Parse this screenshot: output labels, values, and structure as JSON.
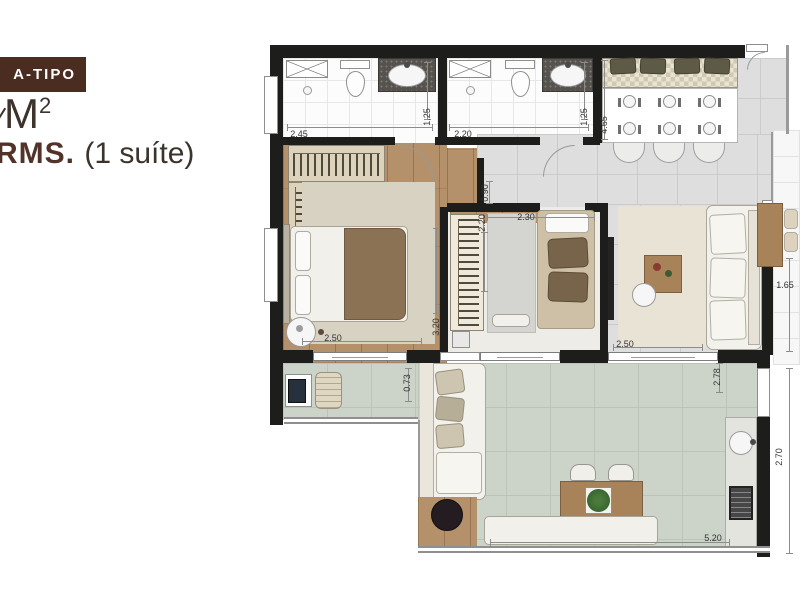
{
  "header": {
    "badge_label": "A-TIPO",
    "area_unit": "M",
    "area_sup": "2",
    "rooms_label": "RMS.",
    "suite_label": "(1 suíte)"
  },
  "colors": {
    "brand_brown": "#4a2c21",
    "wall_black": "#1d1d1b",
    "wood_floor": "#b4906b",
    "terrace_tile": "#ccd3c8",
    "gray_tile": "#dedede"
  },
  "floorplan": {
    "dimensions": [
      {
        "value": "2.45",
        "room": "suite-bathroom",
        "orientation": "horizontal"
      },
      {
        "value": "1.25",
        "room": "suite-bathroom",
        "orientation": "vertical"
      },
      {
        "value": "2.20",
        "room": "bathroom-2",
        "orientation": "horizontal"
      },
      {
        "value": "1.25",
        "room": "bathroom-2",
        "orientation": "vertical"
      },
      {
        "value": "4.65",
        "room": "kitchen-dining",
        "orientation": "vertical"
      },
      {
        "value": "0.90",
        "room": "hallway",
        "orientation": "vertical"
      },
      {
        "value": "2.20",
        "room": "bedroom-2",
        "orientation": "vertical"
      },
      {
        "value": "2.30",
        "room": "bedroom-2",
        "orientation": "horizontal"
      },
      {
        "value": "2.50",
        "room": "master-bedroom",
        "orientation": "horizontal"
      },
      {
        "value": "3.20",
        "room": "master-bedroom",
        "orientation": "vertical"
      },
      {
        "value": "2.50",
        "room": "living-room",
        "orientation": "horizontal"
      },
      {
        "value": "1.65",
        "room": "living-window",
        "orientation": "horizontal"
      },
      {
        "value": "0.73",
        "room": "balcony",
        "orientation": "vertical"
      },
      {
        "value": "2.78",
        "room": "terrace",
        "orientation": "vertical"
      },
      {
        "value": "2.70",
        "room": "terrace-right",
        "orientation": "vertical"
      },
      {
        "value": "5.20",
        "room": "terrace",
        "orientation": "horizontal"
      }
    ]
  }
}
